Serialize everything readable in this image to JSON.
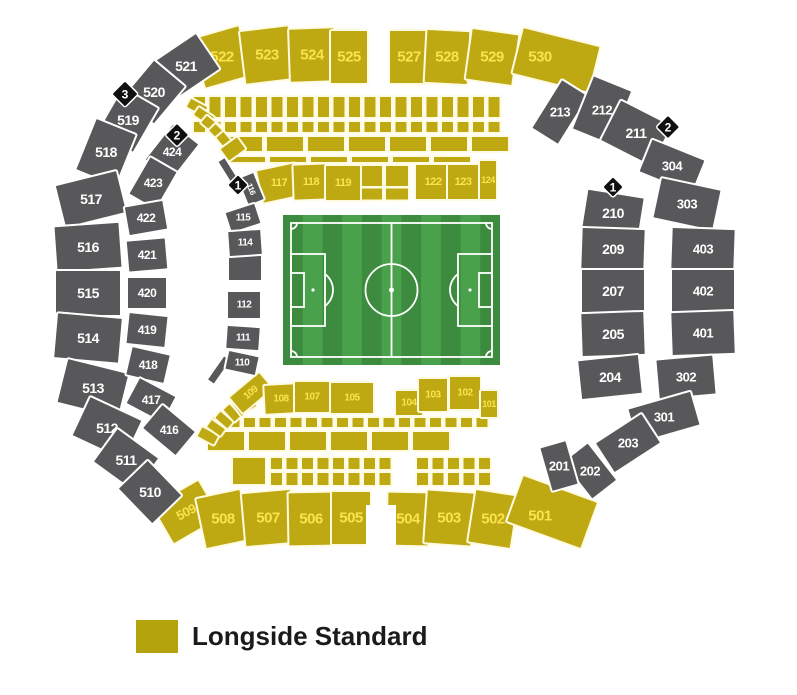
{
  "legend": {
    "label": "Longside Standard",
    "swatch_color": "#b5a30d"
  },
  "colors": {
    "standard_fill": "#bfa913",
    "standard_label": "#f9e44e",
    "standard_stroke": "#fffbe2",
    "unavailable_fill": "#58585a",
    "unavailable_label": "#ffffff",
    "unavailable_stroke": "#ffffff",
    "marker_fill": "#101010",
    "marker_label": "#ffffff",
    "pitch_dark": "#3c8b3e",
    "pitch_light": "#49a14b",
    "pitch_line": "#ffffff",
    "background": "#ffffff"
  },
  "pitch": {
    "x": 283,
    "y": 215,
    "w": 217,
    "h": 150,
    "stripes": 11
  },
  "standard_sections": [
    {
      "n": "522",
      "x": 222,
      "y": 57,
      "w": 50,
      "h": 52,
      "r": -16,
      "fs": 15
    },
    {
      "n": "523",
      "x": 267,
      "y": 55,
      "w": 50,
      "h": 54,
      "r": -7,
      "fs": 15
    },
    {
      "n": "524",
      "x": 312,
      "y": 55,
      "w": 46,
      "h": 54,
      "r": -2,
      "fs": 15
    },
    {
      "n": "525",
      "x": 349,
      "y": 57,
      "w": 38,
      "h": 54,
      "r": 0,
      "fs": 15
    },
    {
      "n": "527",
      "x": 409,
      "y": 57,
      "w": 40,
      "h": 54,
      "r": 0,
      "fs": 15
    },
    {
      "n": "528",
      "x": 447,
      "y": 57,
      "w": 44,
      "h": 54,
      "r": 3,
      "fs": 15
    },
    {
      "n": "529",
      "x": 492,
      "y": 57,
      "w": 48,
      "h": 52,
      "r": 8,
      "fs": 15
    },
    {
      "n": "530",
      "x": 556,
      "y": 60,
      "w": 80,
      "h": 48,
      "r": 14,
      "fs": 15,
      "lx": -16,
      "ly": -3
    },
    {
      "n": "117",
      "x": 279,
      "y": 183,
      "w": 40,
      "h": 34,
      "r": -12,
      "fs": 11
    },
    {
      "n": "118",
      "x": 311,
      "y": 182,
      "w": 36,
      "h": 36,
      "r": -2,
      "fs": 11
    },
    {
      "n": "119",
      "x": 343,
      "y": 183,
      "w": 36,
      "h": 36,
      "r": 0,
      "fs": 11
    },
    {
      "n": "122",
      "x": 433,
      "y": 182,
      "w": 36,
      "h": 36,
      "r": 0,
      "fs": 11
    },
    {
      "n": "123",
      "x": 463,
      "y": 182,
      "w": 32,
      "h": 36,
      "r": 0,
      "fs": 11
    },
    {
      "n": "124",
      "x": 488,
      "y": 180,
      "w": 18,
      "h": 40,
      "r": 0,
      "fs": 9
    },
    {
      "n": "109",
      "x": 251,
      "y": 393,
      "w": 40,
      "h": 22,
      "r": -40,
      "fs": 10,
      "lr": -40
    },
    {
      "n": "108",
      "x": 281,
      "y": 399,
      "w": 34,
      "h": 30,
      "r": -3,
      "fs": 10
    },
    {
      "n": "107",
      "x": 312,
      "y": 397,
      "w": 36,
      "h": 32,
      "r": 0,
      "fs": 10
    },
    {
      "n": "105",
      "x": 352,
      "y": 398,
      "w": 44,
      "h": 32,
      "r": 0,
      "fs": 10
    },
    {
      "n": "104",
      "x": 409,
      "y": 403,
      "w": 28,
      "h": 26,
      "r": 0,
      "fs": 10
    },
    {
      "n": "103",
      "x": 433,
      "y": 395,
      "w": 30,
      "h": 34,
      "r": 0,
      "fs": 10
    },
    {
      "n": "102",
      "x": 465,
      "y": 393,
      "w": 32,
      "h": 34,
      "r": 0,
      "fs": 10
    },
    {
      "n": "101",
      "x": 489,
      "y": 404,
      "w": 18,
      "h": 28,
      "r": 0,
      "fs": 9
    },
    {
      "n": "509",
      "x": 186,
      "y": 512,
      "w": 54,
      "h": 44,
      "r": -30,
      "fs": 13,
      "lr": -28
    },
    {
      "n": "508",
      "x": 223,
      "y": 519,
      "w": 46,
      "h": 52,
      "r": -12,
      "fs": 15
    },
    {
      "n": "507",
      "x": 268,
      "y": 518,
      "w": 50,
      "h": 54,
      "r": -5,
      "fs": 15
    },
    {
      "n": "506",
      "x": 311,
      "y": 519,
      "w": 46,
      "h": 54,
      "r": -1,
      "fs": 15
    },
    {
      "n": "505",
      "x": 351,
      "y": 518,
      "w": 40,
      "h": 54,
      "r": 0,
      "fs": 15
    },
    {
      "n": "504",
      "x": 408,
      "y": 519,
      "w": 42,
      "h": 54,
      "r": 1,
      "fs": 15
    },
    {
      "n": "503",
      "x": 449,
      "y": 518,
      "w": 48,
      "h": 54,
      "r": 4,
      "fs": 15
    },
    {
      "n": "502",
      "x": 493,
      "y": 519,
      "w": 44,
      "h": 54,
      "r": 9,
      "fs": 15
    },
    {
      "n": "501",
      "x": 552,
      "y": 512,
      "w": 80,
      "h": 50,
      "r": 20,
      "fs": 15,
      "lx": -12,
      "ly": 4
    }
  ],
  "unavailable_sections": [
    {
      "n": "521",
      "x": 186,
      "y": 66,
      "w": 54,
      "h": 44,
      "r": -34,
      "fs": 14
    },
    {
      "n": "520",
      "x": 154,
      "y": 92,
      "w": 50,
      "h": 42,
      "r": -50,
      "fs": 14
    },
    {
      "n": "519",
      "x": 128,
      "y": 120,
      "w": 52,
      "h": 42,
      "r": -60,
      "fs": 14
    },
    {
      "n": "518",
      "x": 106,
      "y": 152,
      "w": 56,
      "h": 44,
      "r": -68,
      "fs": 14
    },
    {
      "n": "517",
      "x": 91,
      "y": 199,
      "w": 64,
      "h": 44,
      "r": -14,
      "fs": 14
    },
    {
      "n": "516",
      "x": 88,
      "y": 247,
      "w": 66,
      "h": 46,
      "r": -4,
      "fs": 14
    },
    {
      "n": "515",
      "x": 88,
      "y": 293,
      "w": 66,
      "h": 46,
      "r": 0,
      "fs": 14
    },
    {
      "n": "514",
      "x": 88,
      "y": 338,
      "w": 66,
      "h": 46,
      "r": 5,
      "fs": 14
    },
    {
      "n": "513",
      "x": 93,
      "y": 388,
      "w": 64,
      "h": 46,
      "r": 14,
      "fs": 14
    },
    {
      "n": "512",
      "x": 107,
      "y": 428,
      "w": 58,
      "h": 44,
      "r": 25,
      "fs": 14
    },
    {
      "n": "511",
      "x": 126,
      "y": 460,
      "w": 52,
      "h": 42,
      "r": 36,
      "fs": 14
    },
    {
      "n": "510",
      "x": 150,
      "y": 492,
      "w": 50,
      "h": 42,
      "r": 46,
      "fs": 14
    },
    {
      "n": "424",
      "x": 172,
      "y": 152,
      "w": 46,
      "h": 34,
      "r": -52,
      "fs": 12
    },
    {
      "n": "423",
      "x": 153,
      "y": 183,
      "w": 44,
      "h": 32,
      "r": -60,
      "fs": 12
    },
    {
      "n": "422",
      "x": 146,
      "y": 218,
      "w": 40,
      "h": 30,
      "r": -10,
      "fs": 12
    },
    {
      "n": "421",
      "x": 147,
      "y": 255,
      "w": 40,
      "h": 32,
      "r": -5,
      "fs": 12
    },
    {
      "n": "420",
      "x": 147,
      "y": 293,
      "w": 40,
      "h": 32,
      "r": 0,
      "fs": 12
    },
    {
      "n": "419",
      "x": 147,
      "y": 330,
      "w": 40,
      "h": 32,
      "r": 6,
      "fs": 12
    },
    {
      "n": "418",
      "x": 148,
      "y": 365,
      "w": 40,
      "h": 30,
      "r": 13,
      "fs": 12
    },
    {
      "n": "417",
      "x": 151,
      "y": 400,
      "w": 42,
      "h": 30,
      "r": 28,
      "fs": 12
    },
    {
      "n": "416",
      "x": 169,
      "y": 430,
      "w": 44,
      "h": 32,
      "r": 40,
      "fs": 12
    },
    {
      "n": "116",
      "x": 251,
      "y": 189,
      "w": 30,
      "h": 18,
      "r": 68,
      "fs": 8,
      "lr": 68
    },
    {
      "n": "115",
      "x": 243,
      "y": 218,
      "w": 32,
      "h": 22,
      "r": -18,
      "fs": 10
    },
    {
      "n": "114",
      "x": 245,
      "y": 243,
      "w": 34,
      "h": 26,
      "r": -4,
      "fs": 10
    },
    {
      "n": "112",
      "x": 244,
      "y": 305,
      "w": 34,
      "h": 28,
      "r": 0,
      "fs": 10
    },
    {
      "n": "111",
      "x": 243,
      "y": 338,
      "w": 34,
      "h": 24,
      "r": 4,
      "fs": 10
    },
    {
      "n": "110",
      "x": 242,
      "y": 363,
      "w": 32,
      "h": 20,
      "r": 12,
      "fs": 10
    },
    {
      "n": "213",
      "x": 560,
      "y": 112,
      "w": 32,
      "h": 58,
      "r": 32,
      "fs": 13
    },
    {
      "n": "212",
      "x": 602,
      "y": 110,
      "w": 42,
      "h": 58,
      "r": 22,
      "fs": 13
    },
    {
      "n": "211",
      "x": 636,
      "y": 133,
      "w": 58,
      "h": 46,
      "r": 27,
      "fs": 14
    },
    {
      "n": "304",
      "x": 672,
      "y": 166,
      "w": 58,
      "h": 36,
      "r": 22,
      "fs": 13
    },
    {
      "n": "303",
      "x": 687,
      "y": 204,
      "w": 62,
      "h": 42,
      "r": 12,
      "fs": 13
    },
    {
      "n": "210",
      "x": 613,
      "y": 213,
      "w": 58,
      "h": 40,
      "r": 9,
      "fs": 14
    },
    {
      "n": "209",
      "x": 613,
      "y": 249,
      "w": 64,
      "h": 42,
      "r": 2,
      "fs": 14
    },
    {
      "n": "403",
      "x": 703,
      "y": 249,
      "w": 64,
      "h": 42,
      "r": 2,
      "fs": 13
    },
    {
      "n": "207",
      "x": 613,
      "y": 291,
      "w": 64,
      "h": 44,
      "r": 0,
      "fs": 14
    },
    {
      "n": "402",
      "x": 703,
      "y": 291,
      "w": 64,
      "h": 44,
      "r": 0,
      "fs": 13
    },
    {
      "n": "205",
      "x": 613,
      "y": 334,
      "w": 64,
      "h": 44,
      "r": -2,
      "fs": 14
    },
    {
      "n": "401",
      "x": 703,
      "y": 333,
      "w": 64,
      "h": 44,
      "r": -2,
      "fs": 13
    },
    {
      "n": "204",
      "x": 610,
      "y": 377,
      "w": 62,
      "h": 40,
      "r": -6,
      "fs": 14
    },
    {
      "n": "302",
      "x": 686,
      "y": 377,
      "w": 58,
      "h": 40,
      "r": -5,
      "fs": 13
    },
    {
      "n": "301",
      "x": 664,
      "y": 417,
      "w": 66,
      "h": 36,
      "r": -16,
      "fs": 13
    },
    {
      "n": "203",
      "x": 628,
      "y": 443,
      "w": 56,
      "h": 36,
      "r": -33,
      "fs": 13
    },
    {
      "n": "202",
      "x": 590,
      "y": 471,
      "w": 32,
      "h": 48,
      "r": -38,
      "fs": 13
    },
    {
      "n": "201",
      "x": 559,
      "y": 466,
      "w": 28,
      "h": 46,
      "r": -16,
      "fs": 13
    }
  ],
  "markers": [
    {
      "n": "3",
      "x": 125,
      "y": 94,
      "s": 19
    },
    {
      "n": "2",
      "x": 177,
      "y": 135,
      "s": 17
    },
    {
      "n": "1",
      "x": 238,
      "y": 185,
      "s": 15
    },
    {
      "n": "2",
      "x": 668,
      "y": 127,
      "s": 17
    },
    {
      "n": "1",
      "x": 613,
      "y": 187,
      "s": 15
    }
  ]
}
